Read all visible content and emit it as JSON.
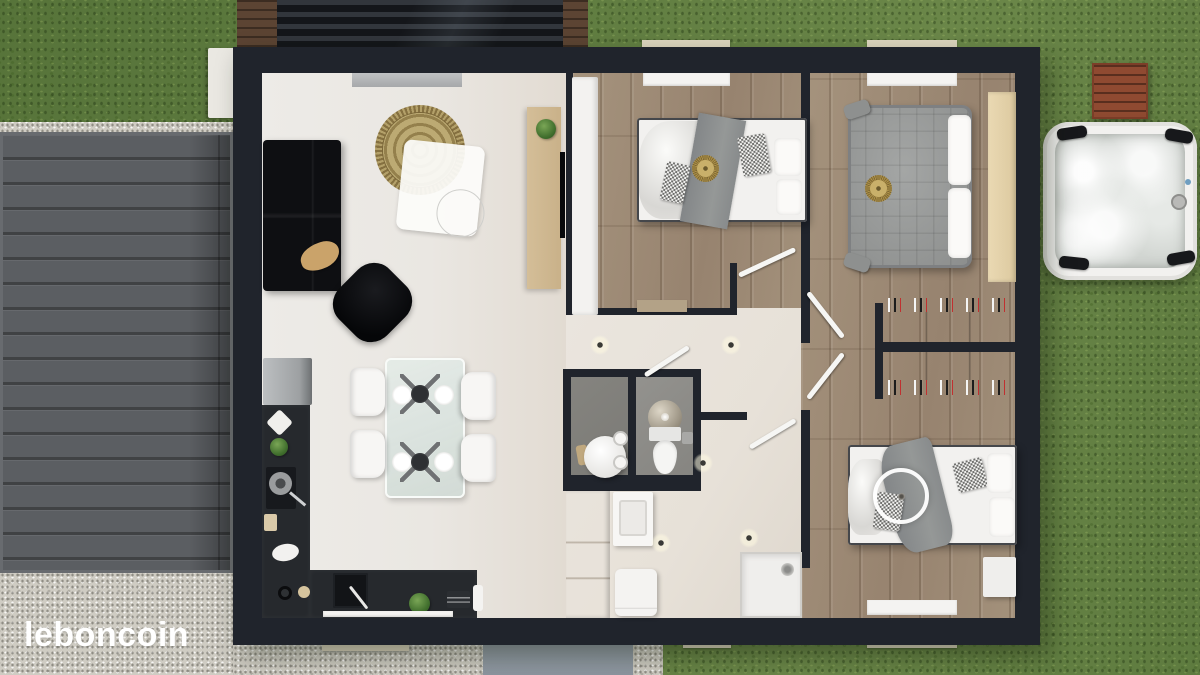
{
  "watermark": {
    "label": "leboncoin"
  },
  "colors": {
    "grass": "#5e7b3f",
    "gravel": "#cfccc3",
    "deck": "#5b5e62",
    "path": "#8d96a0",
    "wall": "#20242c",
    "hall_floor": "#e7e1d8",
    "wood_floor": "#a29078",
    "counter": "#26292d",
    "cabinet_wood": "#c9b189",
    "duvet": "#f2f1ef",
    "quilt": "#9b9d9c",
    "gold": "#b09349",
    "closet": "#b7b9bb",
    "tub_shell": "#f2f1ef",
    "tub_water": "#d2d6d2",
    "pallet": "#8f4a31",
    "watermark": "#ffffff"
  }
}
